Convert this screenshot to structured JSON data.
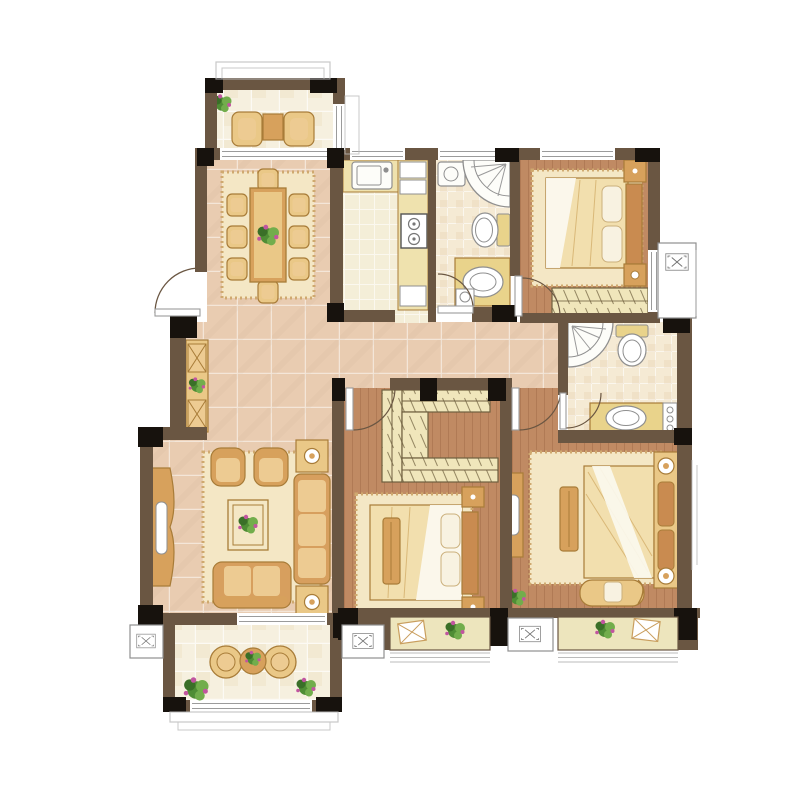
{
  "plan": {
    "style": "hand-drawn watercolor apartment floor plan, no text labels",
    "rooms": [
      {
        "id": "dining-balcony",
        "floor": "balcony-tile",
        "items": [
          "wicker-armchair",
          "wicker-armchair",
          "tea-table",
          "potted-plant"
        ]
      },
      {
        "id": "dining-room",
        "floor": "warm-tile",
        "items": [
          "dining-table",
          "chair-x8",
          "area-rug",
          "plant-centerpiece"
        ]
      },
      {
        "id": "kitchen",
        "floor": "cream-tile",
        "items": [
          "sink",
          "refrigerator",
          "cooktop",
          "l-shaped-counter"
        ]
      },
      {
        "id": "bathroom-1",
        "floor": "bath-tile",
        "items": [
          "corner-shower",
          "washbasin",
          "toilet",
          "vanity-sink",
          "washer"
        ]
      },
      {
        "id": "bedroom-2",
        "floor": "wood-plank",
        "items": [
          "double-bed",
          "nightstand",
          "nightstand",
          "area-rug",
          "fitted-wardrobe"
        ]
      },
      {
        "id": "bathroom-2",
        "floor": "bath-tile",
        "items": [
          "corner-shower",
          "toilet",
          "vanity-sink",
          "washer"
        ]
      },
      {
        "id": "entry-hall",
        "floor": "warm-tile",
        "items": [
          "entry-door",
          "shoe-cabinet",
          "potted-plant"
        ]
      },
      {
        "id": "living-room",
        "floor": "warm-tile",
        "items": [
          "tv-console",
          "armchair",
          "armchair",
          "sofa",
          "loveseat",
          "coffee-table",
          "side-table",
          "side-table",
          "area-rug"
        ]
      },
      {
        "id": "bedroom-3",
        "floor": "wood-plank",
        "items": [
          "walk-in-closet",
          "double-bed",
          "bed-bench",
          "nightstand",
          "nightstand",
          "area-rug"
        ]
      },
      {
        "id": "master-bedroom",
        "floor": "wood-plank",
        "items": [
          "double-bed",
          "headboard-console",
          "bed-bench",
          "dresser",
          "chaise-lounge",
          "area-rug",
          "potted-plant"
        ]
      },
      {
        "id": "living-balcony",
        "floor": "balcony-tile",
        "items": [
          "round-chair",
          "round-chair",
          "round-table",
          "potted-plant",
          "potted-plant"
        ]
      },
      {
        "id": "bay-window-south-left",
        "items": [
          "potted-plant",
          "decor-box"
        ]
      },
      {
        "id": "bay-window-south-right",
        "items": [
          "potted-plant",
          "decor-box"
        ]
      },
      {
        "id": "ac-platforms",
        "count": 4
      }
    ]
  },
  "palette": {
    "wall": "#6a5642",
    "column": "#17120d",
    "wood": "#c08a63",
    "woodLine": "#a26d49",
    "tileWarm": "#e9ccb1",
    "tileCream": "#f4eed8",
    "tileBath": "#f5ead4",
    "tileBalcony": "#f6f0df",
    "counter": "#efe2ae",
    "vanity": "#e9d38b",
    "closet": "#f0e6bb",
    "closetLine": "#6f5f3f",
    "rug": "#f4e7c5",
    "rugEdge": "#cfa96f",
    "furnGold": "#eac887",
    "furnTan": "#d7a15c",
    "furnBrown": "#c58a4b",
    "furnStroke": "#a87c38",
    "bedding": "#f2dfae",
    "duvet": "#fbf8ee",
    "pillow": "#f8f2e1",
    "headboard": "#c98b50",
    "fixture": "#fdfdf9",
    "fixtureStroke": "#8f8f8f",
    "lineGray": "#9b9b9b",
    "exterior": "#bbbbbb",
    "sofa": "#d79f5e",
    "cushion": "#edcb92",
    "green": "#4f8d35",
    "greenLight": "#72ad4c",
    "greenDark": "#3a6f28",
    "flower": "#c155a0",
    "seatBay": "#ede5bd",
    "white": "#ffffff"
  }
}
